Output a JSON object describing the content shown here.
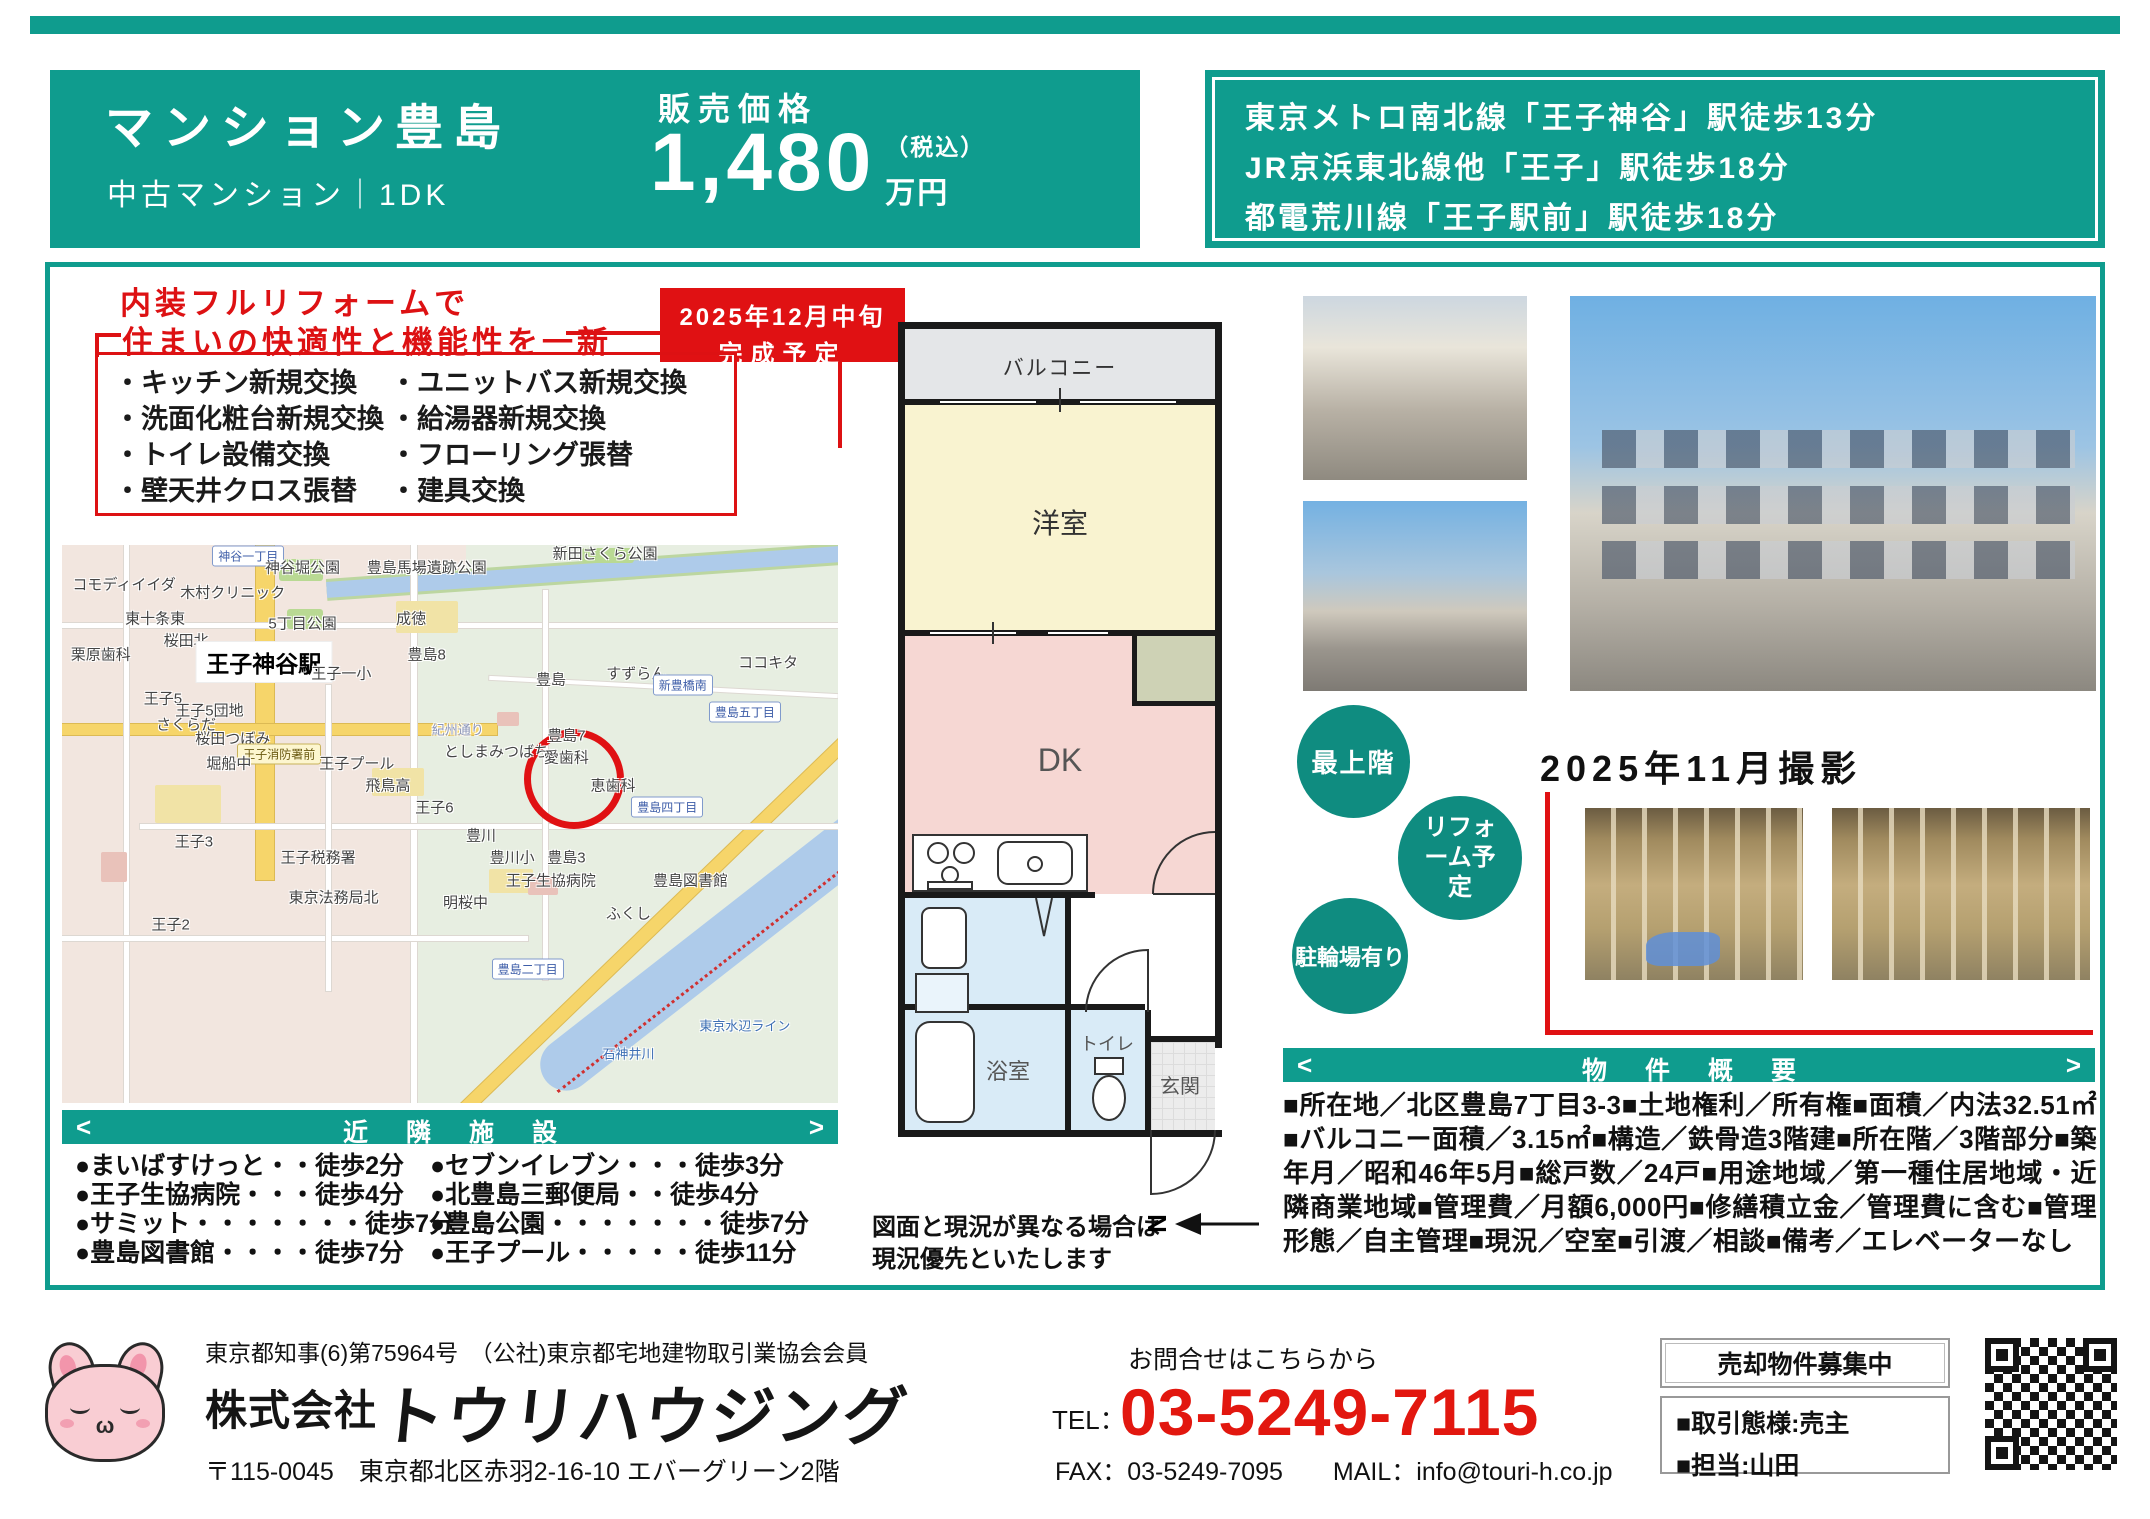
{
  "colors": {
    "teal": "#0f9c8e",
    "red": "#e01113",
    "price_red": "#e2170f"
  },
  "header": {
    "property_name": "マンション豊島",
    "property_type": "中古マンション｜1DK",
    "price_label": "販売価格",
    "price_value": "1,480",
    "price_tax": "（税込）",
    "price_unit": "万円",
    "access_lines": [
      "東京メトロ南北線「王子神谷」駅徒歩13分",
      "JR京浜東北線他「王子」駅徒歩18分",
      "都電荒川線「王子駅前」駅徒歩18分"
    ]
  },
  "renovation": {
    "headline_line1": "内装フルリフォームで",
    "headline_line2": "住まいの快適性と機能性を一新",
    "badge_line1": "2025年12月中旬",
    "badge_line2": "完成予定",
    "items_left": [
      "・キッチン新規交換",
      "・洗面化粧台新規交換",
      "・トイレ設備交換",
      "・壁天井クロス張替"
    ],
    "items_right": [
      "・ユニットバス新規交換",
      "・給湯器新規交換",
      "・フローリング張替",
      "・建具交換"
    ]
  },
  "map": {
    "labels": [
      {
        "t": "コモディイイダ",
        "x": 8,
        "y": 7
      },
      {
        "t": "神谷一丁目",
        "x": 24,
        "y": 2,
        "k": "badge"
      },
      {
        "t": "木村クリニック",
        "x": 22,
        "y": 8.5
      },
      {
        "t": "神谷堀公園",
        "x": 31,
        "y": 4
      },
      {
        "t": "豊島馬場遺跡公園",
        "x": 47,
        "y": 4
      },
      {
        "t": "新田さくら公園",
        "x": 70,
        "y": 1.5
      },
      {
        "t": "東十条東",
        "x": 12,
        "y": 13
      },
      {
        "t": "桜田北",
        "x": 16,
        "y": 17
      },
      {
        "t": "5丁目公園",
        "x": 31,
        "y": 14
      },
      {
        "t": "成徳",
        "x": 45,
        "y": 13
      },
      {
        "t": "栗原歯科",
        "x": 5,
        "y": 19.5
      },
      {
        "t": "王子神谷駅",
        "x": 26,
        "y": 21,
        "k": "station"
      },
      {
        "t": "王子一小",
        "x": 36,
        "y": 23
      },
      {
        "t": "豊島8",
        "x": 47,
        "y": 19.5
      },
      {
        "t": "ココキタ",
        "x": 91,
        "y": 21
      },
      {
        "t": "すずらん",
        "x": 74,
        "y": 23
      },
      {
        "t": "豊島",
        "x": 63,
        "y": 24
      },
      {
        "t": "新豊橋南",
        "x": 80,
        "y": 25,
        "k": "badge"
      },
      {
        "t": "王子5",
        "x": 13,
        "y": 27.5
      },
      {
        "t": "王子5団地",
        "x": 19,
        "y": 29.5
      },
      {
        "t": "豊島五丁目",
        "x": 88,
        "y": 30,
        "k": "badge"
      },
      {
        "t": "さくらだ",
        "x": 16,
        "y": 32
      },
      {
        "t": "紀州通り",
        "x": 51,
        "y": 33,
        "k": "road"
      },
      {
        "t": "豊島7",
        "x": 65,
        "y": 34
      },
      {
        "t": "桜田つぼみ",
        "x": 22,
        "y": 34.5
      },
      {
        "t": "としまみつばち",
        "x": 56,
        "y": 37
      },
      {
        "t": "愛歯科",
        "x": 65,
        "y": 38
      },
      {
        "t": "王子消防署前",
        "x": 28,
        "y": 37.5,
        "k": "badgey"
      },
      {
        "t": "堀船中",
        "x": 21.5,
        "y": 39
      },
      {
        "t": "王子プール",
        "x": 38,
        "y": 39
      },
      {
        "t": "恵歯科",
        "x": 71,
        "y": 43
      },
      {
        "t": "飛鳥高",
        "x": 42,
        "y": 43
      },
      {
        "t": "豊島四丁目",
        "x": 78,
        "y": 47,
        "k": "badge"
      },
      {
        "t": "王子6",
        "x": 48,
        "y": 47
      },
      {
        "t": "王子3",
        "x": 17,
        "y": 53
      },
      {
        "t": "豊川",
        "x": 54,
        "y": 52
      },
      {
        "t": "王子税務署",
        "x": 33,
        "y": 56
      },
      {
        "t": "豊川小",
        "x": 58,
        "y": 56
      },
      {
        "t": "豊島3",
        "x": 65,
        "y": 56
      },
      {
        "t": "王子生協病院",
        "x": 63,
        "y": 60
      },
      {
        "t": "豊島図書館",
        "x": 81,
        "y": 60
      },
      {
        "t": "東京法務局北",
        "x": 35,
        "y": 63
      },
      {
        "t": "明桜中",
        "x": 52,
        "y": 64
      },
      {
        "t": "ふくし",
        "x": 73,
        "y": 66
      },
      {
        "t": "王子2",
        "x": 14,
        "y": 68
      },
      {
        "t": "豊島二丁目",
        "x": 60,
        "y": 76,
        "k": "badge"
      },
      {
        "t": "東京水辺ライン",
        "x": 88,
        "y": 86,
        "k": "water"
      },
      {
        "t": "石神井川",
        "x": 73,
        "y": 91,
        "k": "water"
      }
    ]
  },
  "nearby": {
    "title": "近隣施設",
    "arrow_left": "<",
    "arrow_right": ">",
    "left": [
      "●まいばすけっと・・徒歩2分",
      "●王子生協病院・・・徒歩4分",
      "●サミット・・・・・・・徒歩7分",
      "●豊島図書館・・・・徒歩7分"
    ],
    "right": [
      "●セブンイレブン・・・徒歩3分",
      "●北豊島三郵便局・・徒歩4分",
      "●豊島公園・・・・・・・徒歩7分",
      "●王子プール・・・・・徒歩11分"
    ]
  },
  "floorplan": {
    "balcony": "バルコニー",
    "western_room": "洋室",
    "dk": "DK",
    "bath": "浴室",
    "toilet": "トイレ",
    "entrance": "玄関",
    "laundry_l1": "洗濯機",
    "laundry_l2": "置場",
    "north": "N",
    "note_line1": "図面と現況が異なる場合は",
    "note_line2": "現況優先といたします"
  },
  "badges": {
    "top_floor": "最上階",
    "reform": "リフォーム予定",
    "bicycle": "駐輪場有り"
  },
  "photos": {
    "shoot_date": "2025年11月撮影"
  },
  "overview": {
    "title": "物件概要",
    "arrow_left": "<",
    "arrow_right": ">",
    "text": "■所在地／北区豊島7丁目3-3■土地権利／所有権■面積／内法32.51㎡■バルコニー面積／3.15㎡■構造／鉄骨造3階建■所在階／3階部分■築年月／昭和46年5月■総戸数／24戸■用途地域／第一種住居地域・近隣商業地域■管理費／月額6,000円■修繕積立金／管理費に含む■管理形態／自主管理■現況／空室■引渡／相談■備考／エレベーターなし"
  },
  "footer": {
    "license": "東京都知事(6)第75964号　（公社)東京都宅地建物取引業協会会員",
    "company_prefix": "株式会社",
    "company_name": "トウリハウジング",
    "address": "〒115-0045　東京都北区赤羽2-16-10 エバーグリーン2階",
    "contact_label": "お問合せはこちらから",
    "tel_label": "TEL：",
    "tel_number": "03-5249-7115",
    "fax_mail": "FAX：03-5249-7095　　MAIL：info@touri-h.co.jp",
    "recruit": "売却物件募集中",
    "deal_type": "■取引態様:売主",
    "agent": "■担当:山田"
  }
}
